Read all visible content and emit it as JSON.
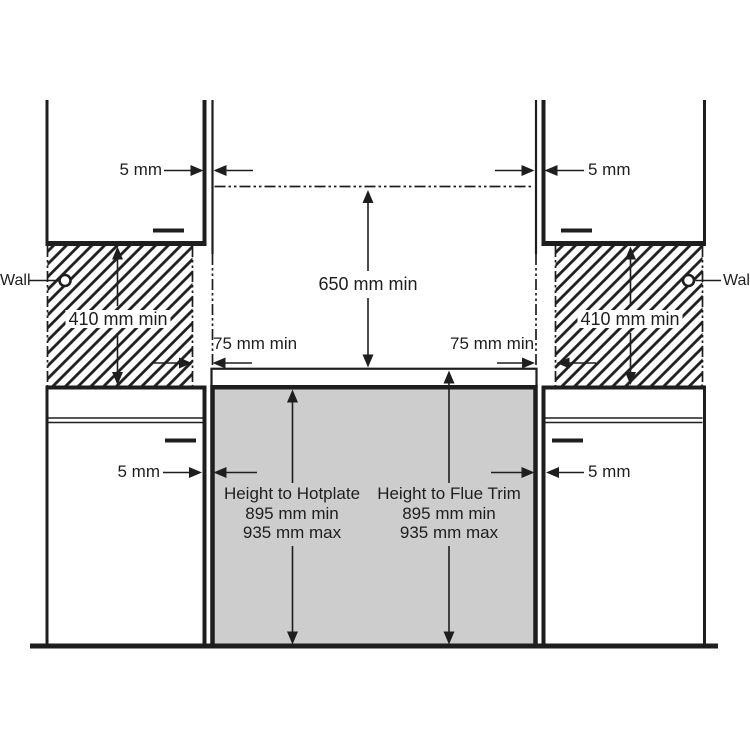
{
  "diagram_title": "Cooker installation clearance diagram",
  "colors": {
    "line": "#1e1e1e",
    "cooker_fill": "#cdcdcd",
    "hatch_line": "#b3b3b3",
    "background": "#ffffff"
  },
  "labels": {
    "wall_left": "Wall",
    "wall_right": "Wall",
    "gap_top_left": "5 mm",
    "gap_top_right": "5 mm",
    "gap_bottom_left": "5 mm",
    "gap_bottom_right": "5 mm",
    "side_wall_clearance_left": "410 mm min",
    "side_wall_clearance_right": "410 mm min",
    "overhead_clearance": "650 mm min",
    "side_gap_left": "75 mm min",
    "side_gap_right": "75 mm min",
    "height_to_hotplate": {
      "title": "Height to Hotplate",
      "min": "895 mm min",
      "max": "935 mm max"
    },
    "height_to_flue_trim": {
      "title": "Height to Flue Trim",
      "min": "895 mm min",
      "max": "935 mm max"
    }
  }
}
